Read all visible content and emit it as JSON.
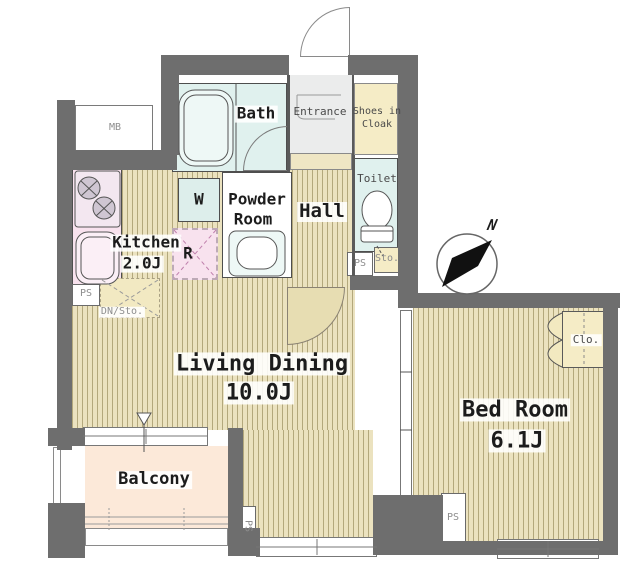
{
  "plan": {
    "type": "apartment-floor-plan",
    "rooms": {
      "living_dining": {
        "name": "Living Dining",
        "size": "10.0J"
      },
      "bedroom": {
        "name": "Bed Room",
        "size": "6.1J"
      },
      "kitchen": {
        "name": "Kitchen",
        "size": "2.0J"
      },
      "bath": {
        "name": "Bath"
      },
      "powder_room": {
        "name_line1": "Powder",
        "name_line2": "Room"
      },
      "toilet": {
        "name": "Toilet"
      },
      "hall": {
        "name": "Hall"
      },
      "entrance": {
        "name": "Entrance"
      },
      "shoes_in_cloak": {
        "name_line1": "Shoes in",
        "name_line2": "Cloak"
      },
      "balcony": {
        "name": "Balcony"
      },
      "closet": {
        "name": "Clo."
      }
    },
    "fixtures": {
      "meter_box": "MB",
      "washing_machine": "W",
      "refrigerator": "R",
      "pipe_space": "PS",
      "storage": "Sto.",
      "oven_storage": "DN/Sto."
    },
    "compass": {
      "north": "N"
    },
    "colors": {
      "wall": "#6e6e6e",
      "wood_floor": "#ebe2bf",
      "wet_area": "#e0f1ee",
      "kitchen_pink": "#f8e2ee",
      "closet_cream": "#f5ecc6",
      "balcony_peach": "#fce9d9",
      "entrance_gray": "#ebecec"
    }
  }
}
